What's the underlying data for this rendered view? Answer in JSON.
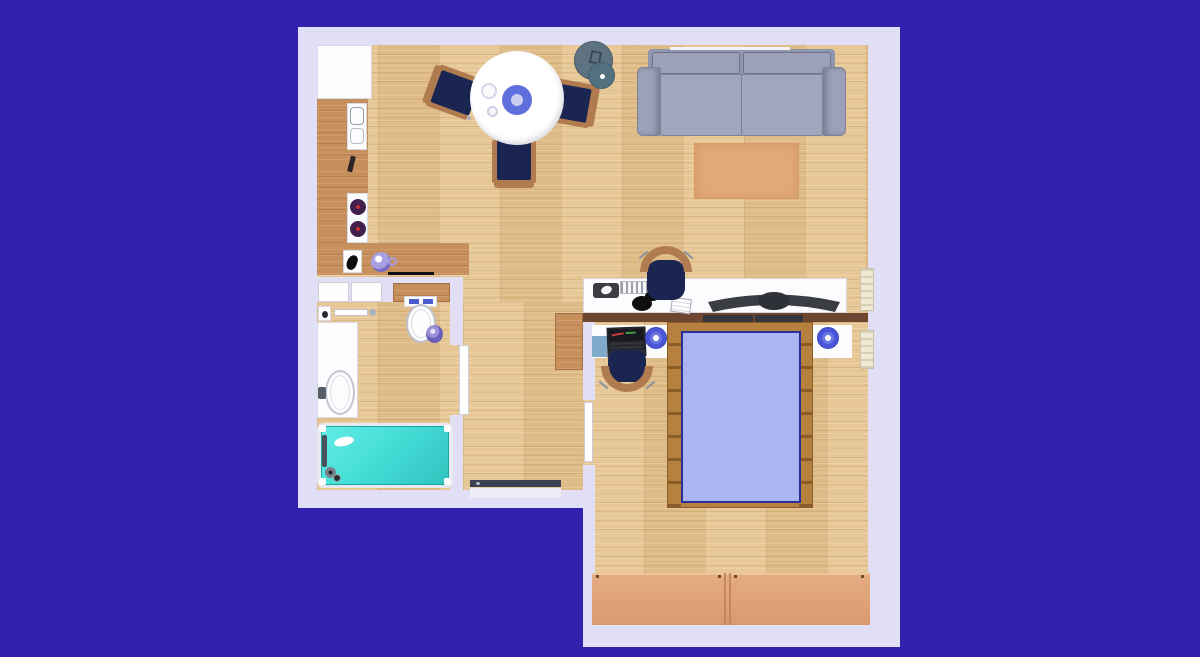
{
  "scene": {
    "description": "Aerial 3D rendering of a one-bedroom apartment floor plan on a blue backdrop",
    "visible_text": []
  },
  "palette": {
    "background": "#3321AE",
    "wall": "#E0DFF6",
    "floor": "#E4C28E",
    "counter_wood": "#C68F5C",
    "shelf_wood": "#C68F5C",
    "bedroom_top_wall": "#6E452E",
    "bedroom_top_wall_dark": "#33363C",
    "chair_navy": "#1B2551",
    "chair_wood": "#B07C4F",
    "table_white": "#FFFFFF",
    "plate_blue": "#5F6FDE",
    "plate_inner": "#CACEF2",
    "floor_lamp_big": "#5E7282",
    "floor_lamp_small": "#52707E",
    "sofa_back": "#9096AC",
    "sofa_cushion": "#9CA1B7",
    "sofa_arm": "#9CA1B9",
    "sofa_seat": "#A1A6BF",
    "sofa_seam": "#70748A",
    "rug": "#E0A977",
    "desk_white": "#FCFCFE",
    "mousepad_dark": "#3C3C42",
    "headphones_black": "#0E0E10",
    "monitor_dark": "#3A3D44",
    "monitor_hub": "#2E3138",
    "nightstand_white": "#FDFDFF",
    "laptop_dark": "#26282E",
    "pad_blue": "#7FAACC",
    "lamp_blue_outer": "#4A55D8",
    "lamp_blue_mid": "#6A76E4",
    "bed_frame_wood": "#B6813F",
    "bed_rung": "#8A5C28",
    "mattress_blue": "#ABB5F1",
    "mattress_border": "#2B2F96",
    "wardrobe_salmon": "#DFA37A",
    "wardrobe_seam": "#C2875C",
    "radiator_cream": "#EFE9D6",
    "radiator_rib": "#D8D0B4",
    "tub_cyan": "#49E0DA",
    "tub_cyan_dark": "#2FC3BE",
    "toilet_button_blue": "#4A5BD0",
    "bin_lavender": "#9A8FD8",
    "teapot_lavender": "#A89EE2",
    "burner_purple": "#41204E",
    "burner_dot_red": "#C03030",
    "entry_door_dark": "#3A4254"
  },
  "rooms": {
    "kitchen": [
      "refrigerator",
      "l-shaped-counter",
      "sink",
      "cooktop",
      "kettle",
      "teapot"
    ],
    "dining": [
      "round-table",
      "plate",
      "glassware",
      "chair-left",
      "chair-right",
      "chair-bottom"
    ],
    "living": [
      "sofa",
      "rug",
      "floor-lamp",
      "desk",
      "keyboard",
      "mouse-pad",
      "headphones",
      "notepad",
      "curved-monitor",
      "desk-chair"
    ],
    "bathroom": [
      "vanity-counter",
      "washbasin",
      "toilet",
      "waste-bin",
      "bathtub",
      "wall-shelf",
      "towel-bar"
    ],
    "hall": [
      "cabinet",
      "entry-door"
    ],
    "bedroom": [
      "double-bed",
      "nightstand-left",
      "nightstand-right",
      "bedside-lamp-left",
      "bedside-lamp-right",
      "laptop",
      "notebook-pad",
      "chair",
      "wardrobe",
      "radiator-upper",
      "radiator-lower"
    ]
  }
}
